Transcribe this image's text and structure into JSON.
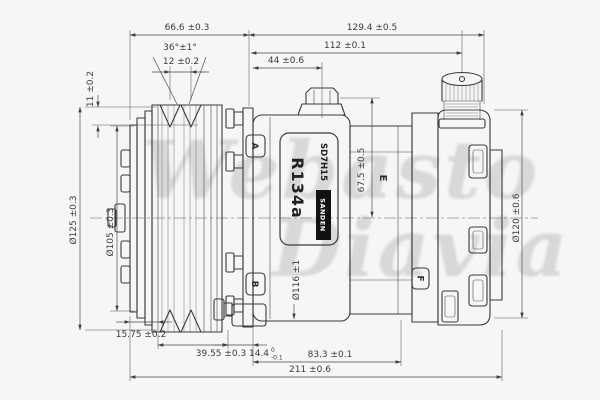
{
  "drawing_title": "SD7H15 compressor dimensional drawing",
  "colors": {
    "background": "#f6f6f5",
    "line": "#3a3a3a",
    "dimension": "#454545",
    "watermark": "#d8d8d8",
    "nameplate_box": "#111111"
  },
  "watermark": {
    "line1": "Webasto",
    "line2": "Diavia"
  },
  "nameplate": {
    "model": "SD7H15",
    "brand": "SANDEN",
    "refrigerant": "R134a"
  },
  "ports": {
    "a": "A",
    "b": "B",
    "e": "E",
    "f": "F"
  },
  "dims": {
    "d66": "66.6 ±0.3",
    "d129": "129.4 ±0.5",
    "d36": "36°±1°",
    "d12": "12 ±0.2",
    "d112": "112 ±0.1",
    "d44": "44 ±0.6",
    "d11": "11 ±0.2",
    "d125": "Ø125 ±0.3",
    "d105": "Ø105 ±0.3",
    "d67": "67.5 ±0.5",
    "d116": "Ø116 ±1",
    "d120": "Ø120 ±0.6",
    "d1575": "15.75 ±0.2",
    "d3955": "39.55 ±0.3",
    "d144": "14.4",
    "d144_hi": "0",
    "d144_lo": "-0.1",
    "d833": "83.3 ±0.1",
    "d211": "211 ±0.6"
  }
}
